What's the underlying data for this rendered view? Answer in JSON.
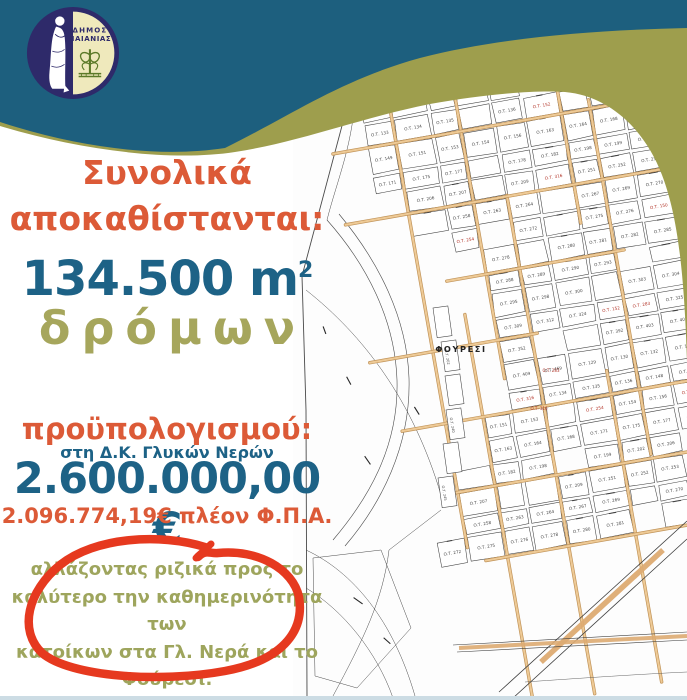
{
  "poster": {
    "logo": {
      "line1": "ΔΗΜΟΣ",
      "line2": "ΠΑΙΑΝΙΑΣ"
    },
    "headline_line1": "Συνολικά",
    "headline_line2": "αποκαθίστανται:",
    "area_value": "134.500 m",
    "area_exponent": "2",
    "area_unit_label": "δρόμων",
    "budget_label": "προϋπολογισμού:",
    "district_note": "στη Δ.Κ. Γλυκών Νερών",
    "budget_total": "2.600.000,00 €",
    "budget_net": "2.096.774,19€ πλέον Φ.Π.Α.",
    "highlight_lines": [
      "αλλάζοντας ριζικά προς το",
      "καλύτερο την καθημερινότητα των",
      "κατοίκων στα Γλ. Νερά και το",
      "Φούρεσι."
    ],
    "colors": {
      "teal_band": "#1d5f7e",
      "olive_band": "#9e9e4d",
      "orange_text": "#dc5a37",
      "blue_text": "#1d6286",
      "olive_text": "#a6a65c",
      "red_circle": "#e6391f",
      "logo_navy": "#2e2a6a",
      "logo_cream": "#efe9bc",
      "map_street_tan": "#ddab72"
    }
  },
  "map": {
    "area_label": "ΦΟΥΡΕΣΙ",
    "block_prefix": "Ο.Τ.",
    "block_numbers": [
      "129",
      "130",
      "132",
      "133",
      "134",
      "135",
      "136",
      "148",
      "149",
      "151",
      "153",
      "154",
      "156",
      "163",
      "164",
      "168",
      "171",
      "175",
      "177",
      "178",
      "182",
      "198",
      "199",
      "202",
      "206",
      "207",
      "209",
      "251",
      "252",
      "253",
      "258",
      "263",
      "264",
      "267",
      "269",
      "270",
      "272",
      "275",
      "276",
      "278",
      "280",
      "281",
      "282",
      "285",
      "288",
      "289",
      "290",
      "293",
      "295",
      "298",
      "300",
      "303",
      "304",
      "309",
      "312",
      "324",
      "325",
      "352",
      "392",
      "403",
      "407",
      "409",
      "469"
    ],
    "red_block_numbers": [
      "150",
      "152",
      "283",
      "316",
      "254"
    ],
    "strip_numbers": [
      "202",
      "240",
      "245"
    ]
  }
}
